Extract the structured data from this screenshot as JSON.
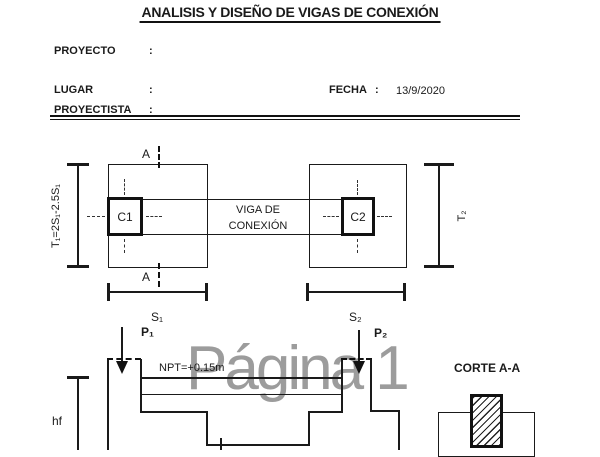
{
  "colors": {
    "ink": "#1a1a1a",
    "watermark": "#9c9c9c"
  },
  "watermark": {
    "text": "Página 1"
  },
  "header": {
    "title": "ANALISIS Y DISEÑO DE VIGAS DE CONEXIÓN",
    "proyecto_label": "PROYECTO",
    "lugar_label": "LUGAR",
    "proyectista_label": "PROYECTISTA",
    "fecha_label": "FECHA",
    "colon": ":",
    "fecha_value": "13/9/2020"
  },
  "plan": {
    "column1_label": "C1",
    "column2_label": "C2",
    "beam_label_line1": "VIGA DE",
    "beam_label_line2": "CONEXIÓN",
    "section_cut_letter": "A",
    "dim_t1_label": "T₁=2S₁-2.5S₁",
    "dim_t2_label": "T₂",
    "dim_s1_label": "S₁",
    "dim_s2_label": "S₂"
  },
  "elevation": {
    "load1_label": "P₁",
    "load2_label": "P₂",
    "npt_label": "NPT=+0.15m",
    "hf_label": "hf"
  },
  "section": {
    "title": "CORTE A-A"
  }
}
